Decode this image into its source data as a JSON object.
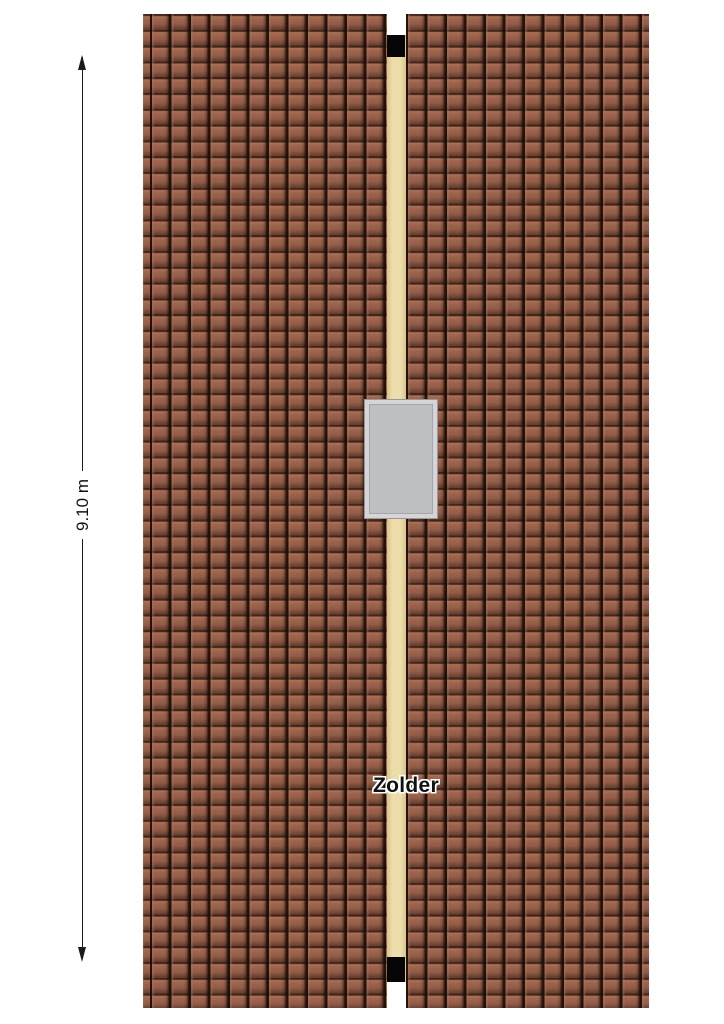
{
  "floorplan": {
    "room_label": "Zolder",
    "dimension_label": "9.10 m"
  },
  "colors": {
    "background": "#ffffff",
    "roof_tile": "#9b624b",
    "roof_tile_dark": "#2a150b",
    "ridge": "#ecddaa",
    "ridge_edge": "#d8c48e",
    "chimney_cap": "#060606",
    "skylight_frame": "#d5d5d7",
    "skylight_glass": "#bdbfc1",
    "skylight_outline": "#98989c",
    "dimension_line": "#1a1a1a",
    "label_text": "#111111"
  }
}
